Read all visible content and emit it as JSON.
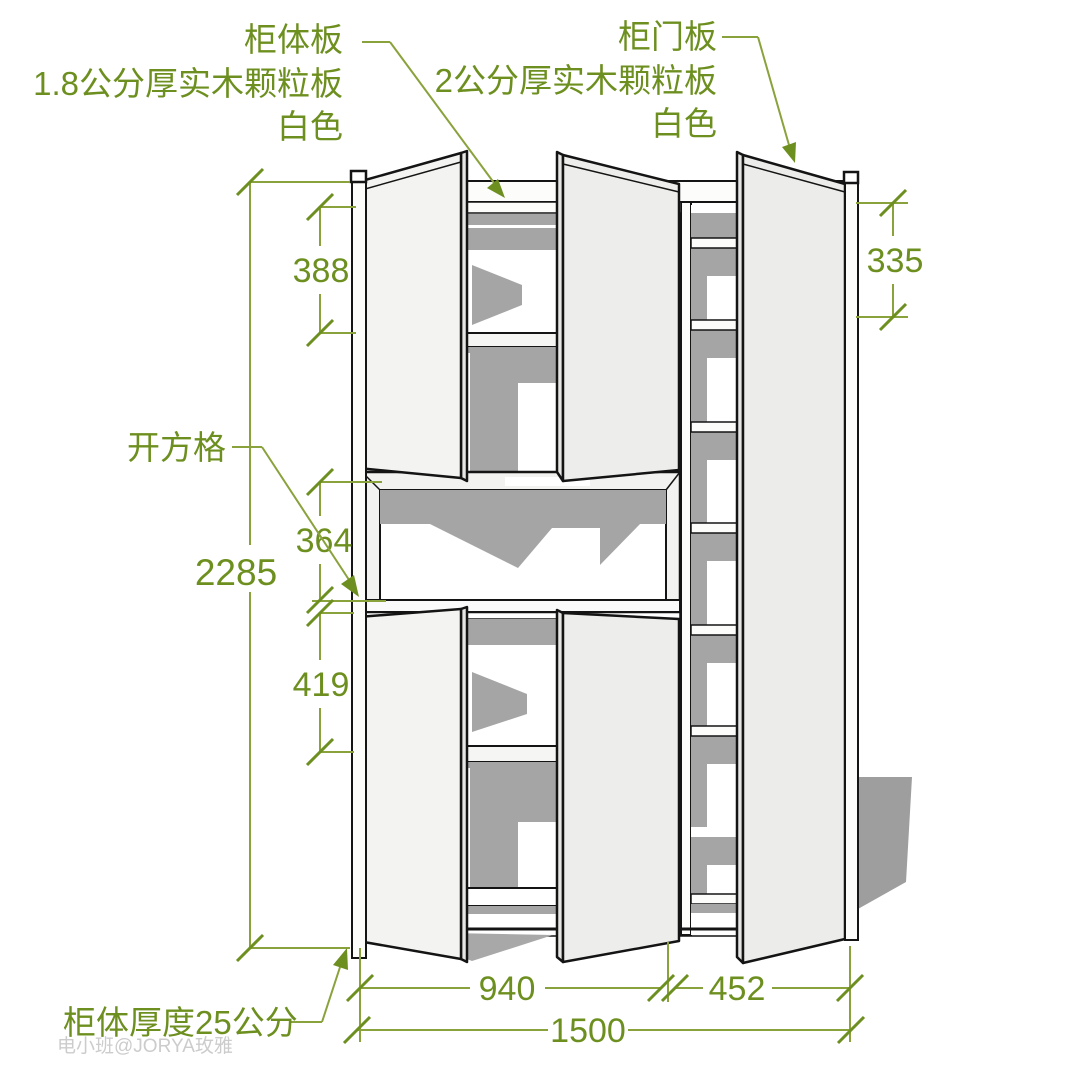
{
  "annotations": {
    "body_panel": {
      "name": "柜体板",
      "spec": "1.8公分厚实木颗粒板",
      "color": "白色"
    },
    "door_panel": {
      "name": "柜门板",
      "spec": "2公分厚实木颗粒板",
      "color": "白色"
    },
    "open_cubby_label": "开方格",
    "body_thickness_label": "柜体厚度25公分"
  },
  "dimensions": {
    "total_height": "2285",
    "upper_left_shelf": "388",
    "open_cubby_height": "364",
    "lower_left_shelf": "419",
    "right_top_shelf": "335",
    "left_section_width": "940",
    "right_section_width": "452",
    "total_width": "1500"
  },
  "watermark": "电小班@JORYA玫雅",
  "colors": {
    "annotation_green": "#6d8f1f",
    "dimension_line_green": "#8aa23c",
    "shadow_gray": "#a5a5a5",
    "outline_black": "#141414",
    "door_white": "#f1f1ef",
    "watermark_gray": "#cccccc",
    "background": "#ffffff"
  }
}
